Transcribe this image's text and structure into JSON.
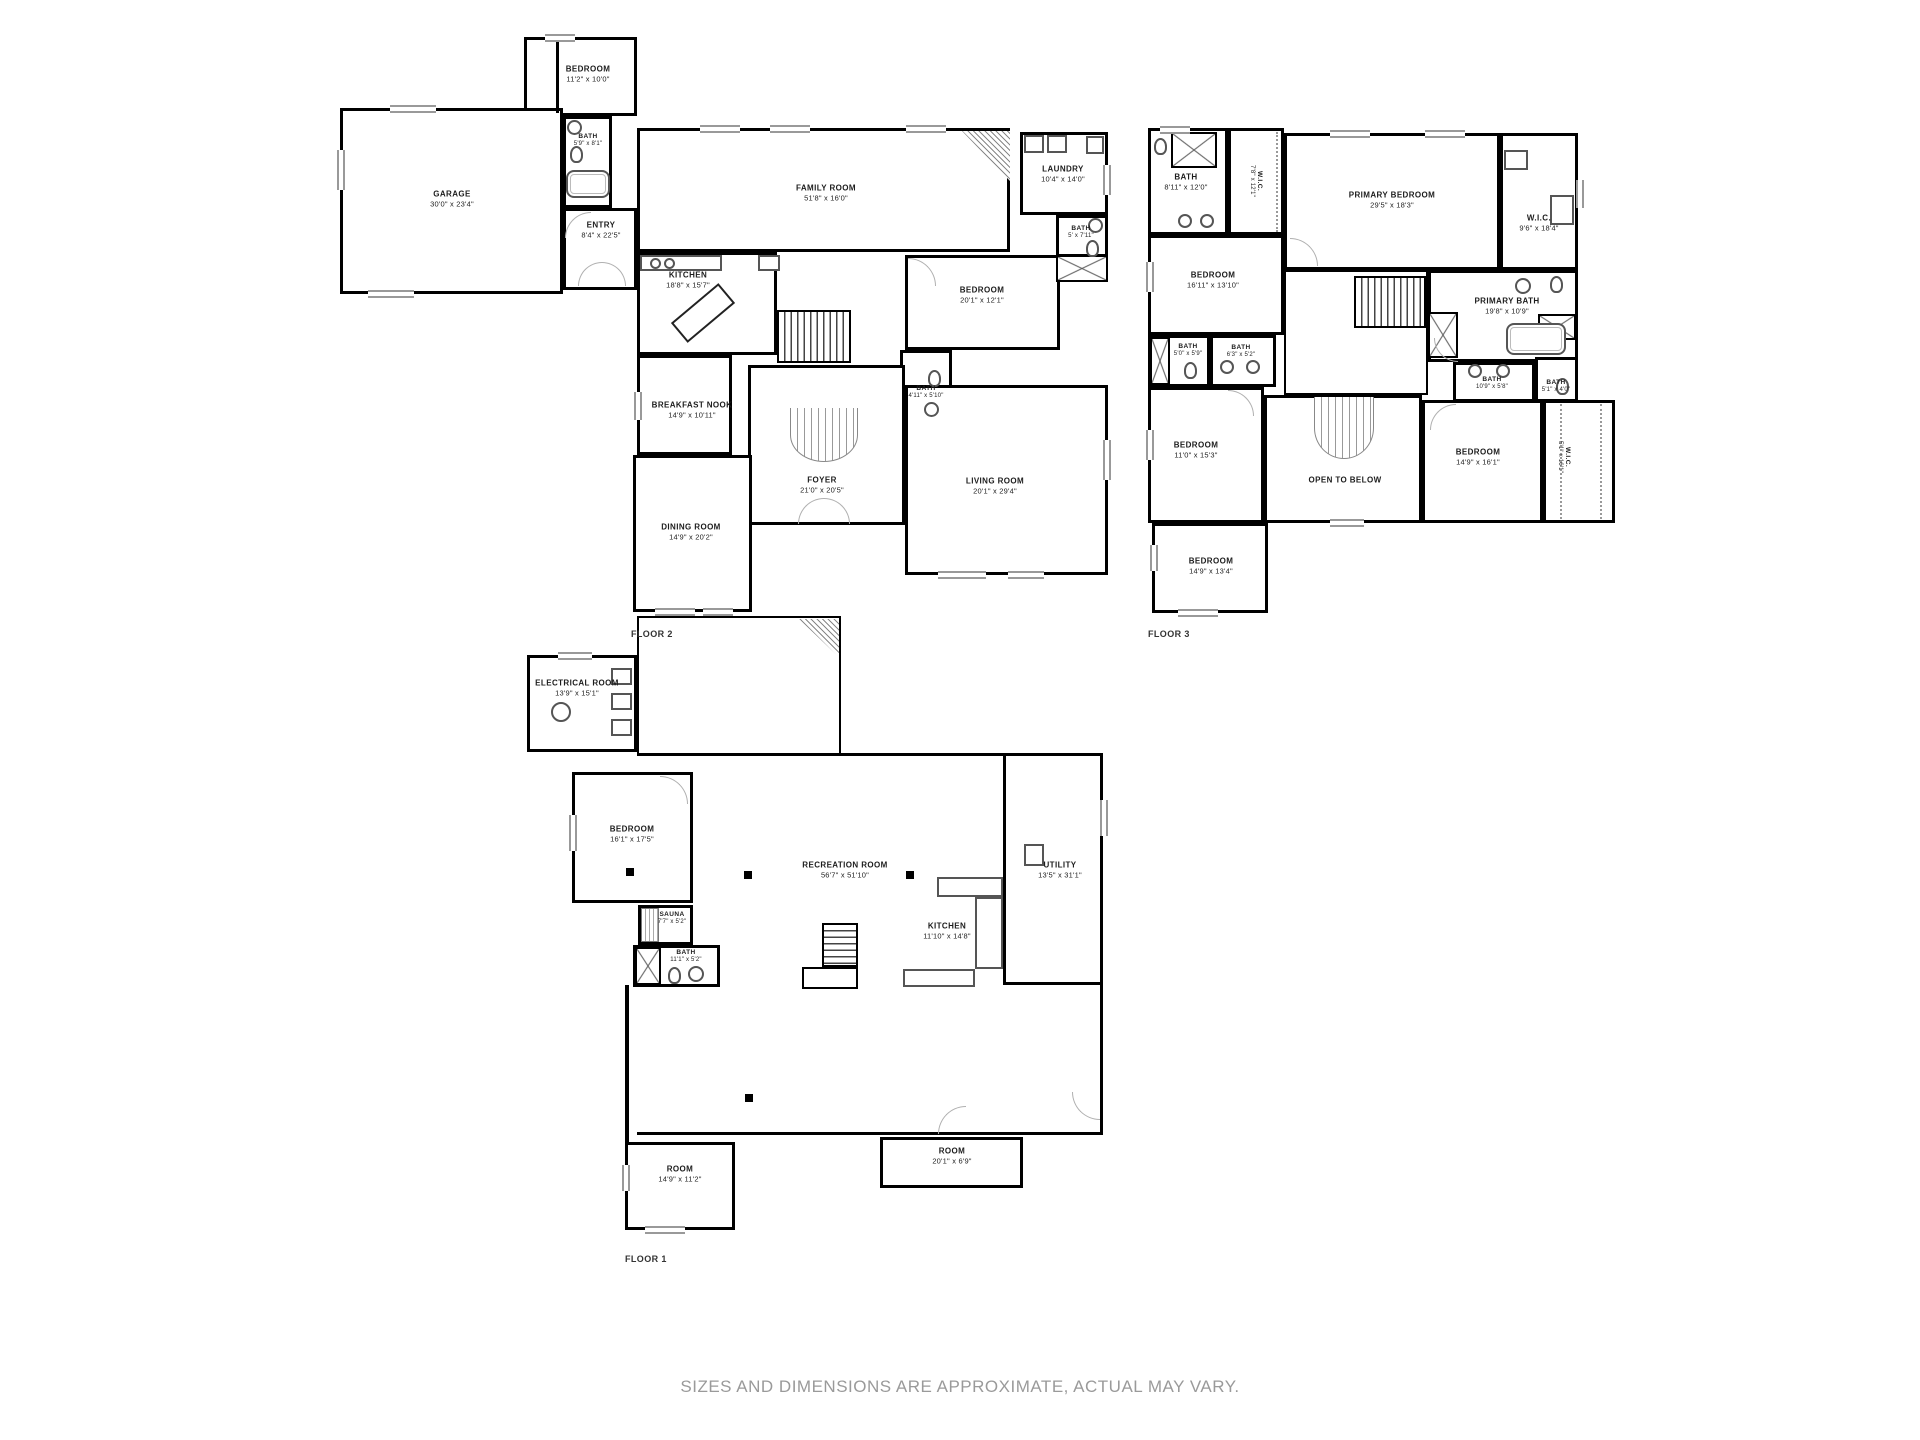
{
  "footer": "SIZES AND DIMENSIONS ARE APPROXIMATE, ACTUAL MAY VARY.",
  "colors": {
    "wall": "#000000",
    "door_arc": "#b0b0b0",
    "footer_text": "#9a9a9a"
  },
  "floors": [
    {
      "label": "FLOOR 2",
      "rooms": [
        {
          "name": "BEDROOM",
          "dims": "11'2\" x 10'0\""
        },
        {
          "name": "GARAGE",
          "dims": "30'0\" x 23'4\""
        },
        {
          "name": "BATH",
          "dims": "5'9\" x 8'1\""
        },
        {
          "name": "ENTRY",
          "dims": "8'4\" x 22'5\""
        },
        {
          "name": "FAMILY ROOM",
          "dims": "51'8\" x 16'0\""
        },
        {
          "name": "LAUNDRY",
          "dims": "10'4\" x 14'0\""
        },
        {
          "name": "BATH",
          "dims": "5' x 7'11\""
        },
        {
          "name": "BEDROOM",
          "dims": "20'1\" x 12'1\""
        },
        {
          "name": "KITCHEN",
          "dims": "18'8\" x 15'7\""
        },
        {
          "name": "BREAKFAST NOOK",
          "dims": "14'9\" x 10'11\""
        },
        {
          "name": "BATH",
          "dims": "4'11\" x 5'10\""
        },
        {
          "name": "FOYER",
          "dims": "21'0\" x 20'5\""
        },
        {
          "name": "LIVING ROOM",
          "dims": "20'1\" x 29'4\""
        },
        {
          "name": "DINING ROOM",
          "dims": "14'9\" x 20'2\""
        }
      ]
    },
    {
      "label": "FLOOR 3",
      "rooms": [
        {
          "name": "BATH",
          "dims": "8'11\" x 12'0\""
        },
        {
          "name": "W.I.C.",
          "dims": "7'8\" x 12'1\""
        },
        {
          "name": "PRIMARY BEDROOM",
          "dims": "29'5\" x 18'3\""
        },
        {
          "name": "W.I.C.",
          "dims": "9'6\" x 18'4\""
        },
        {
          "name": "BEDROOM",
          "dims": "16'11\" x 13'10\""
        },
        {
          "name": "BATH",
          "dims": "5'0\" x 5'9\""
        },
        {
          "name": "BATH",
          "dims": "6'3\" x 5'2\""
        },
        {
          "name": "PRIMARY BATH",
          "dims": "19'8\" x 10'9\""
        },
        {
          "name": "BATH",
          "dims": "10'9\" x 5'8\""
        },
        {
          "name": "BATH",
          "dims": "5'1\" x 4'0\""
        },
        {
          "name": "BEDROOM",
          "dims": "11'0\" x 15'3\""
        },
        {
          "name": "OPEN TO BELOW",
          "dims": ""
        },
        {
          "name": "BEDROOM",
          "dims": "14'9\" x 16'1\""
        },
        {
          "name": "W.I.C.",
          "dims": "5'1\" x 16'1\""
        },
        {
          "name": "BEDROOM",
          "dims": "14'9\" x 13'4\""
        }
      ]
    },
    {
      "label": "FLOOR 1",
      "rooms": [
        {
          "name": "ELECTRICAL ROOM",
          "dims": "13'9\" x 15'1\""
        },
        {
          "name": "BEDROOM",
          "dims": "16'1\" x 17'5\""
        },
        {
          "name": "RECREATION ROOM",
          "dims": "56'7\" x 51'10\""
        },
        {
          "name": "SAUNA",
          "dims": "7'7\" x 5'2\""
        },
        {
          "name": "BATH",
          "dims": "11'1\" x 5'2\""
        },
        {
          "name": "KITCHEN",
          "dims": "11'10\" x 14'8\""
        },
        {
          "name": "UTILITY",
          "dims": "13'5\" x 31'1\""
        },
        {
          "name": "ROOM",
          "dims": "20'1\" x 6'9\""
        },
        {
          "name": "ROOM",
          "dims": "14'9\" x 11'2\""
        }
      ]
    }
  ]
}
